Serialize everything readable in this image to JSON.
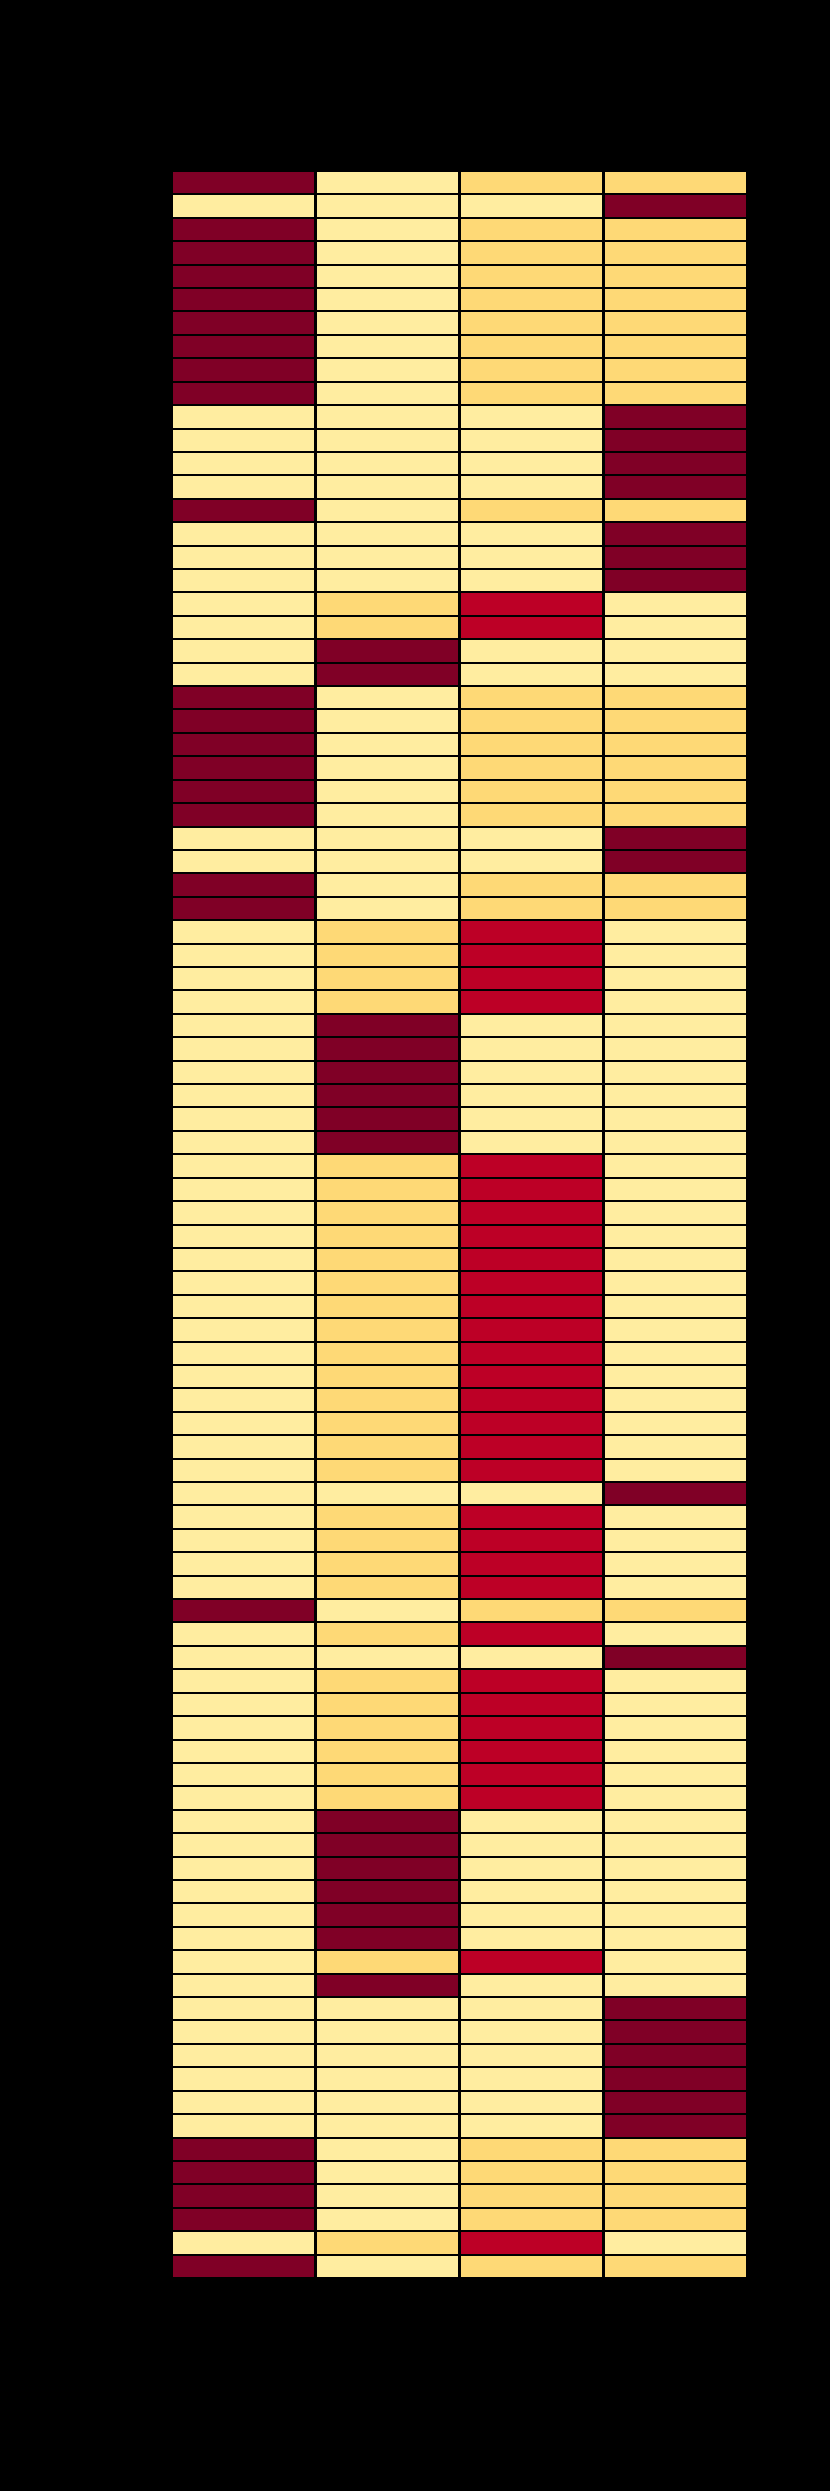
{
  "figure": {
    "background_color": "#000000",
    "plot_area": {
      "left_px": 172,
      "top_px": 171,
      "width_px": 575,
      "height_px": 2107
    },
    "visible_text": [],
    "legend_visible": false,
    "axis_labels_visible": false
  },
  "chart_data": {
    "type": "heatmap",
    "title": "",
    "xlabel": "",
    "ylabel": "",
    "n_rows": 90,
    "n_cols": 4,
    "grid_line_color": "#000000",
    "palette": {
      "1": "#FFEDA0",
      "2": "#FED976",
      "3": "#BD0026",
      "4": "#800026"
    },
    "palette_semantics": "1=light yellow (lowest), 2=orange-yellow, 3=bright red, 4=dark maroon (highest)",
    "rows": [
      [
        4,
        1,
        2,
        2
      ],
      [
        1,
        1,
        1,
        4
      ],
      [
        4,
        1,
        2,
        2
      ],
      [
        4,
        1,
        2,
        2
      ],
      [
        4,
        1,
        2,
        2
      ],
      [
        4,
        1,
        2,
        2
      ],
      [
        4,
        1,
        2,
        2
      ],
      [
        4,
        1,
        2,
        2
      ],
      [
        4,
        1,
        2,
        2
      ],
      [
        4,
        1,
        2,
        2
      ],
      [
        1,
        1,
        1,
        4
      ],
      [
        1,
        1,
        1,
        4
      ],
      [
        1,
        1,
        1,
        4
      ],
      [
        1,
        1,
        1,
        4
      ],
      [
        4,
        1,
        2,
        2
      ],
      [
        1,
        1,
        1,
        4
      ],
      [
        1,
        1,
        1,
        4
      ],
      [
        1,
        1,
        1,
        4
      ],
      [
        1,
        2,
        3,
        1
      ],
      [
        1,
        2,
        3,
        1
      ],
      [
        1,
        4,
        1,
        1
      ],
      [
        1,
        4,
        1,
        1
      ],
      [
        4,
        1,
        2,
        2
      ],
      [
        4,
        1,
        2,
        2
      ],
      [
        4,
        1,
        2,
        2
      ],
      [
        4,
        1,
        2,
        2
      ],
      [
        4,
        1,
        2,
        2
      ],
      [
        4,
        1,
        2,
        2
      ],
      [
        1,
        1,
        1,
        4
      ],
      [
        1,
        1,
        1,
        4
      ],
      [
        4,
        1,
        2,
        2
      ],
      [
        4,
        1,
        2,
        2
      ],
      [
        1,
        2,
        3,
        1
      ],
      [
        1,
        2,
        3,
        1
      ],
      [
        1,
        2,
        3,
        1
      ],
      [
        1,
        2,
        3,
        1
      ],
      [
        1,
        4,
        1,
        1
      ],
      [
        1,
        4,
        1,
        1
      ],
      [
        1,
        4,
        1,
        1
      ],
      [
        1,
        4,
        1,
        1
      ],
      [
        1,
        4,
        1,
        1
      ],
      [
        1,
        4,
        1,
        1
      ],
      [
        1,
        2,
        3,
        1
      ],
      [
        1,
        2,
        3,
        1
      ],
      [
        1,
        2,
        3,
        1
      ],
      [
        1,
        2,
        3,
        1
      ],
      [
        1,
        2,
        3,
        1
      ],
      [
        1,
        2,
        3,
        1
      ],
      [
        1,
        2,
        3,
        1
      ],
      [
        1,
        2,
        3,
        1
      ],
      [
        1,
        2,
        3,
        1
      ],
      [
        1,
        2,
        3,
        1
      ],
      [
        1,
        2,
        3,
        1
      ],
      [
        1,
        2,
        3,
        1
      ],
      [
        1,
        2,
        3,
        1
      ],
      [
        1,
        2,
        3,
        1
      ],
      [
        1,
        1,
        1,
        4
      ],
      [
        1,
        2,
        3,
        1
      ],
      [
        1,
        2,
        3,
        1
      ],
      [
        1,
        2,
        3,
        1
      ],
      [
        1,
        2,
        3,
        1
      ],
      [
        4,
        1,
        2,
        2
      ],
      [
        1,
        2,
        3,
        1
      ],
      [
        1,
        1,
        1,
        4
      ],
      [
        1,
        2,
        3,
        1
      ],
      [
        1,
        2,
        3,
        1
      ],
      [
        1,
        2,
        3,
        1
      ],
      [
        1,
        2,
        3,
        1
      ],
      [
        1,
        2,
        3,
        1
      ],
      [
        1,
        2,
        3,
        1
      ],
      [
        1,
        4,
        1,
        1
      ],
      [
        1,
        4,
        1,
        1
      ],
      [
        1,
        4,
        1,
        1
      ],
      [
        1,
        4,
        1,
        1
      ],
      [
        1,
        4,
        1,
        1
      ],
      [
        1,
        4,
        1,
        1
      ],
      [
        1,
        2,
        3,
        1
      ],
      [
        1,
        4,
        1,
        1
      ],
      [
        1,
        1,
        1,
        4
      ],
      [
        1,
        1,
        1,
        4
      ],
      [
        1,
        1,
        1,
        4
      ],
      [
        1,
        1,
        1,
        4
      ],
      [
        1,
        1,
        1,
        4
      ],
      [
        1,
        1,
        1,
        4
      ],
      [
        4,
        1,
        2,
        2
      ],
      [
        4,
        1,
        2,
        2
      ],
      [
        4,
        1,
        2,
        2
      ],
      [
        4,
        1,
        2,
        2
      ],
      [
        1,
        2,
        3,
        1
      ],
      [
        4,
        1,
        2,
        2
      ]
    ]
  }
}
